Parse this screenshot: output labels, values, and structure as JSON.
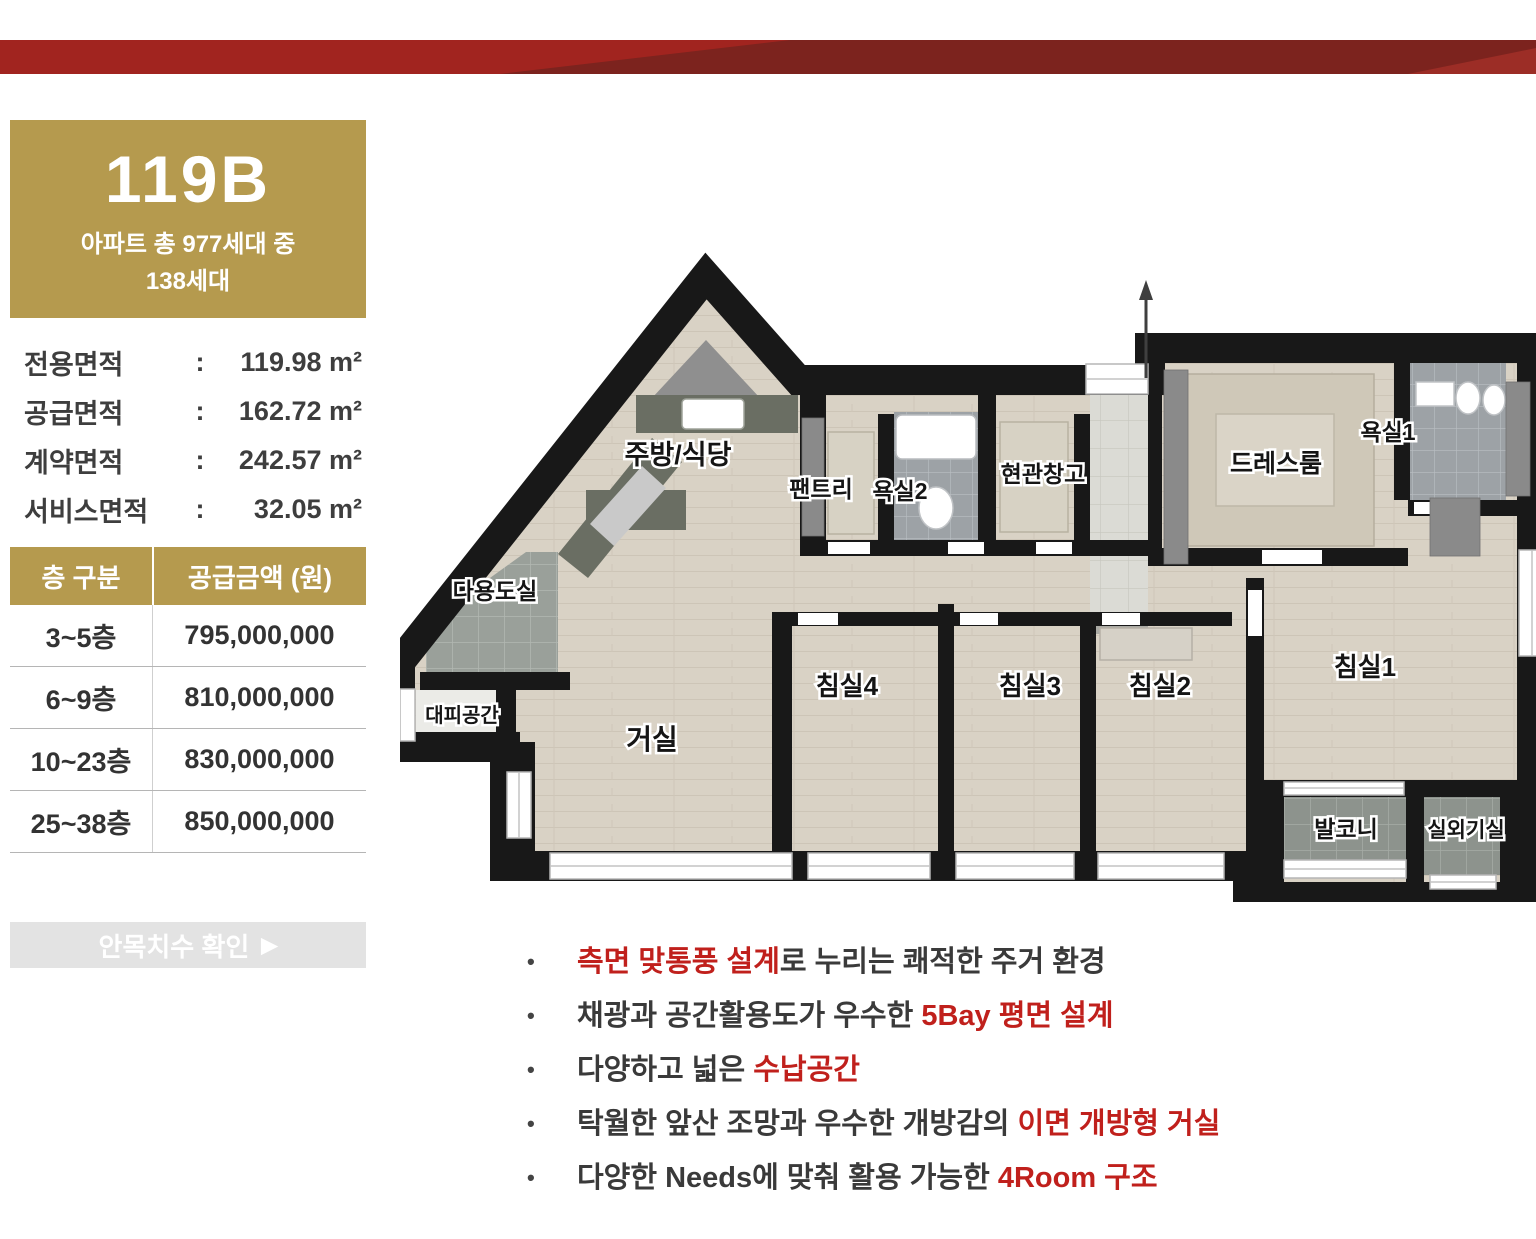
{
  "theme": {
    "gold": "#b59a4e",
    "accent": "#c0201c",
    "band_bright": "#a1241f",
    "band_dark": "#7c231e",
    "band_corner": "#9c2d26",
    "wall": "#181818"
  },
  "unit": {
    "code": "119B",
    "subtitle_line1": "아파트 총 977세대 중",
    "subtitle_line2": "138세대"
  },
  "specs": {
    "rows": [
      {
        "label": "전용면적",
        "value": "119.98 m²"
      },
      {
        "label": "공급면적",
        "value": "162.72 m²"
      },
      {
        "label": "계약면적",
        "value": "242.57 m²"
      },
      {
        "label": "서비스면적",
        "value": "32.05 m²"
      }
    ]
  },
  "price_table": {
    "header_floor": "층 구분",
    "header_amount": "공급금액 (원)",
    "rows": [
      {
        "floor": "3~5층",
        "amount": "795,000,000"
      },
      {
        "floor": "6~9층",
        "amount": "810,000,000"
      },
      {
        "floor": "10~23층",
        "amount": "830,000,000"
      },
      {
        "floor": "25~38층",
        "amount": "850,000,000"
      }
    ]
  },
  "cta": {
    "label": "안목치수 확인",
    "arrow": "▶"
  },
  "floorplan": {
    "rooms": [
      {
        "id": "kitchen-dining",
        "label": "주방/식당",
        "x": 278,
        "y": 212,
        "size": 27
      },
      {
        "id": "pantry",
        "label": "팬트리",
        "x": 421,
        "y": 245,
        "size": 23
      },
      {
        "id": "bathroom-2",
        "label": "욕실2",
        "x": 500,
        "y": 247,
        "size": 23
      },
      {
        "id": "entry-storage",
        "label": "현관창고",
        "x": 643,
        "y": 230,
        "size": 23
      },
      {
        "id": "dress-room",
        "label": "드레스룸",
        "x": 876,
        "y": 220,
        "size": 25
      },
      {
        "id": "bathroom-1",
        "label": "욕실1",
        "x": 988,
        "y": 188,
        "size": 23
      },
      {
        "id": "utility-room",
        "label": "다용도실",
        "x": 95,
        "y": 347,
        "size": 23
      },
      {
        "id": "evacuation-space",
        "label": "대피공간",
        "x": 62,
        "y": 470,
        "size": 20
      },
      {
        "id": "living-room",
        "label": "거실",
        "x": 252,
        "y": 497,
        "size": 28
      },
      {
        "id": "bedroom-4",
        "label": "침실4",
        "x": 447,
        "y": 443,
        "size": 26
      },
      {
        "id": "bedroom-3",
        "label": "침실3",
        "x": 630,
        "y": 443,
        "size": 26
      },
      {
        "id": "bedroom-2",
        "label": "침실2",
        "x": 760,
        "y": 443,
        "size": 26
      },
      {
        "id": "bedroom-1",
        "label": "침실1",
        "x": 965,
        "y": 424,
        "size": 26
      },
      {
        "id": "balcony",
        "label": "발코니",
        "x": 946,
        "y": 585,
        "size": 23
      },
      {
        "id": "ac-unit-room",
        "label": "실외기실",
        "x": 1066,
        "y": 585,
        "size": 21
      }
    ]
  },
  "features": {
    "bullet": "•",
    "items": [
      {
        "segments": [
          {
            "text": "측면 맞통풍 설계",
            "color": "red"
          },
          {
            "text": "로 누리는 쾌적한 주거 환경",
            "color": "dark"
          }
        ]
      },
      {
        "segments": [
          {
            "text": "채광과 공간활용도가 우수한 ",
            "color": "dark"
          },
          {
            "text": "5Bay 평면 설계",
            "color": "red"
          }
        ]
      },
      {
        "segments": [
          {
            "text": "다양하고 넓은 ",
            "color": "dark"
          },
          {
            "text": "수납공간",
            "color": "red"
          }
        ]
      },
      {
        "segments": [
          {
            "text": "탁월한 앞산 조망과 우수한 개방감의 ",
            "color": "dark"
          },
          {
            "text": "이면 개방형 거실",
            "color": "red"
          }
        ]
      },
      {
        "segments": [
          {
            "text": "다양한 Needs에 맞춰 활용 가능한 ",
            "color": "dark"
          },
          {
            "text": "4Room 구조",
            "color": "red"
          }
        ]
      }
    ]
  }
}
